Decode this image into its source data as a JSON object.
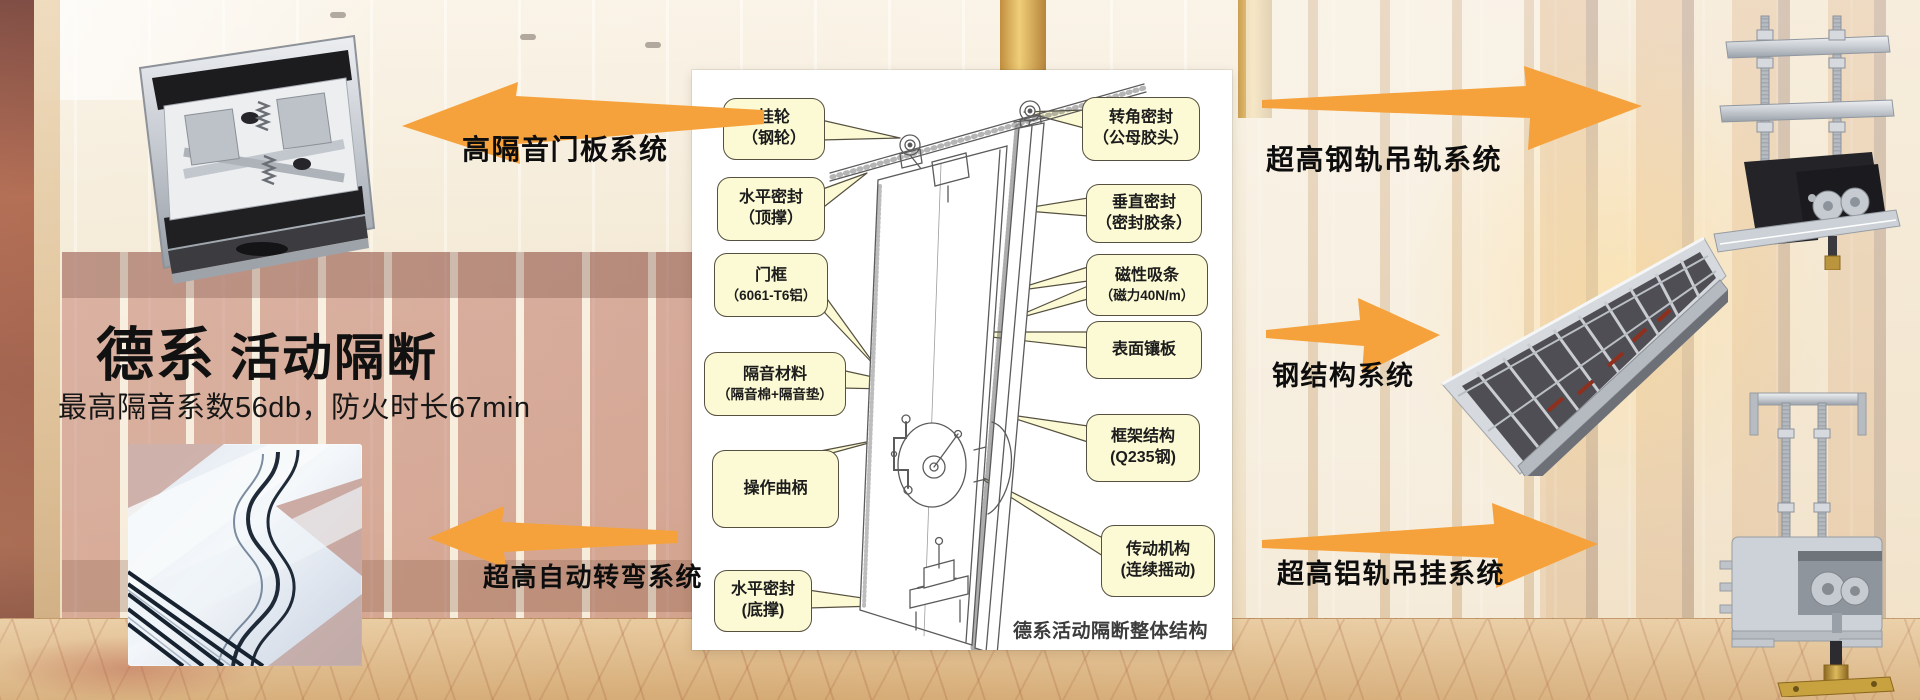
{
  "title": {
    "brand": "德系",
    "product": "活动隔断",
    "subtitle": "最高隔音系数56db，防火时长67min"
  },
  "system_arrows": {
    "door_panel": {
      "label": "高隔音门板系统",
      "direction": "left"
    },
    "auto_turn": {
      "label": "超高自动转弯系统",
      "direction": "left"
    },
    "steel_rail": {
      "label": "超高钢轨吊轨系统",
      "direction": "right"
    },
    "steel_structure": {
      "label": "钢结构系统",
      "direction": "right"
    },
    "alu_rail": {
      "label": "超高铝轨吊挂系统",
      "direction": "right"
    }
  },
  "diagram": {
    "caption": "德系活动隔断整体结构",
    "callouts_left": [
      {
        "line1": "挂轮",
        "line2": "（钢轮）"
      },
      {
        "line1": "水平密封",
        "line2": "（顶撑）"
      },
      {
        "line1": "门框",
        "line2": "（6061-T6铝）"
      },
      {
        "line1": "隔音材料",
        "line2": "（隔音棉+隔音垫）"
      },
      {
        "line1": "操作曲柄",
        "line2": ""
      },
      {
        "line1": "水平密封",
        "line2": "(底撑)"
      }
    ],
    "callouts_right": [
      {
        "line1": "转角密封",
        "line2": "（公母胶头）"
      },
      {
        "line1": "垂直密封",
        "line2": "（密封胶条）"
      },
      {
        "line1": "磁性吸条",
        "line2": "（磁力40N/m）"
      },
      {
        "line1": "表面镶板",
        "line2": ""
      },
      {
        "line1": "框架结构",
        "line2": "(Q235钢)"
      },
      {
        "line1": "传动机构",
        "line2": "(连续摇动)"
      }
    ]
  },
  "colors": {
    "arrow_orange": "#F6A23C",
    "callout_fill": "#FCFAD4",
    "callout_border": "#55503F"
  }
}
